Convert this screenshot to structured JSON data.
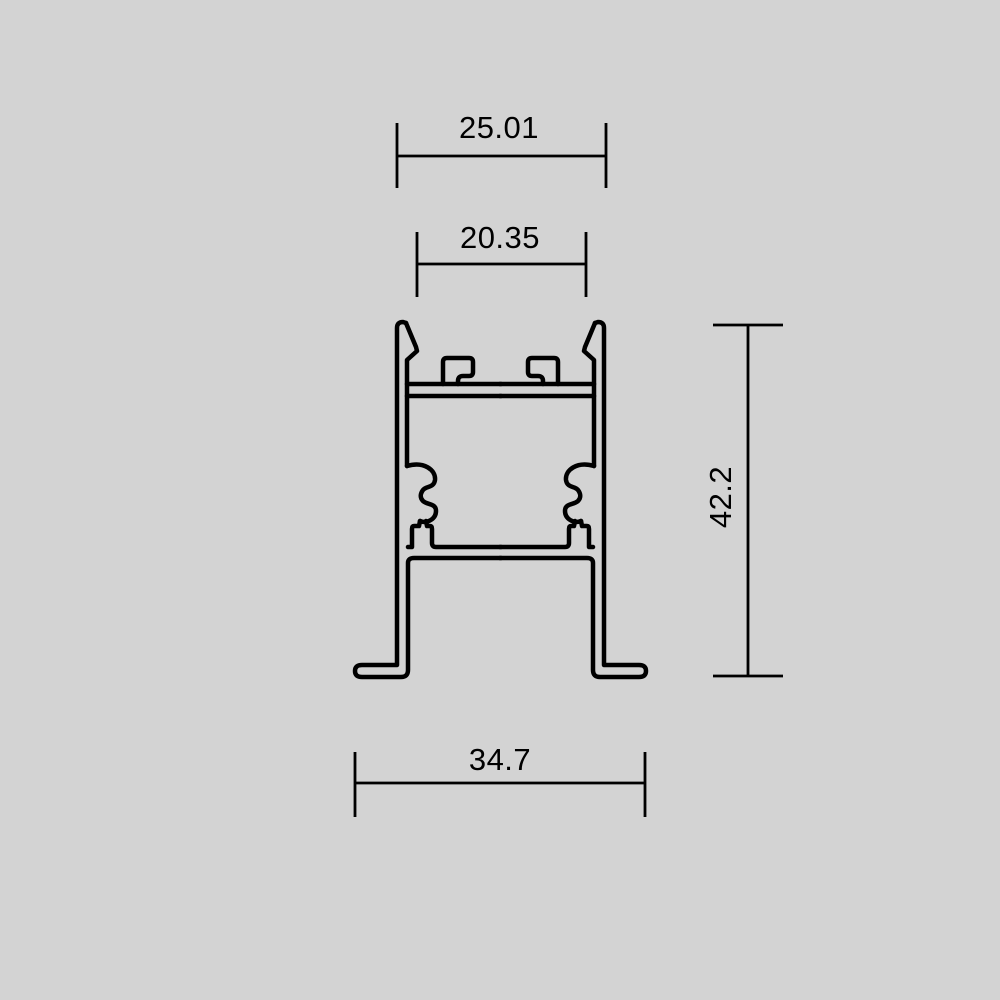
{
  "page": {
    "background_color": "#d3d3d3",
    "line_color": "#000000"
  },
  "diagram": {
    "dimensions": {
      "top_outer_width": "25.01",
      "top_opening_width": "20.35",
      "overall_height": "42.2",
      "base_width": "34.7"
    }
  }
}
